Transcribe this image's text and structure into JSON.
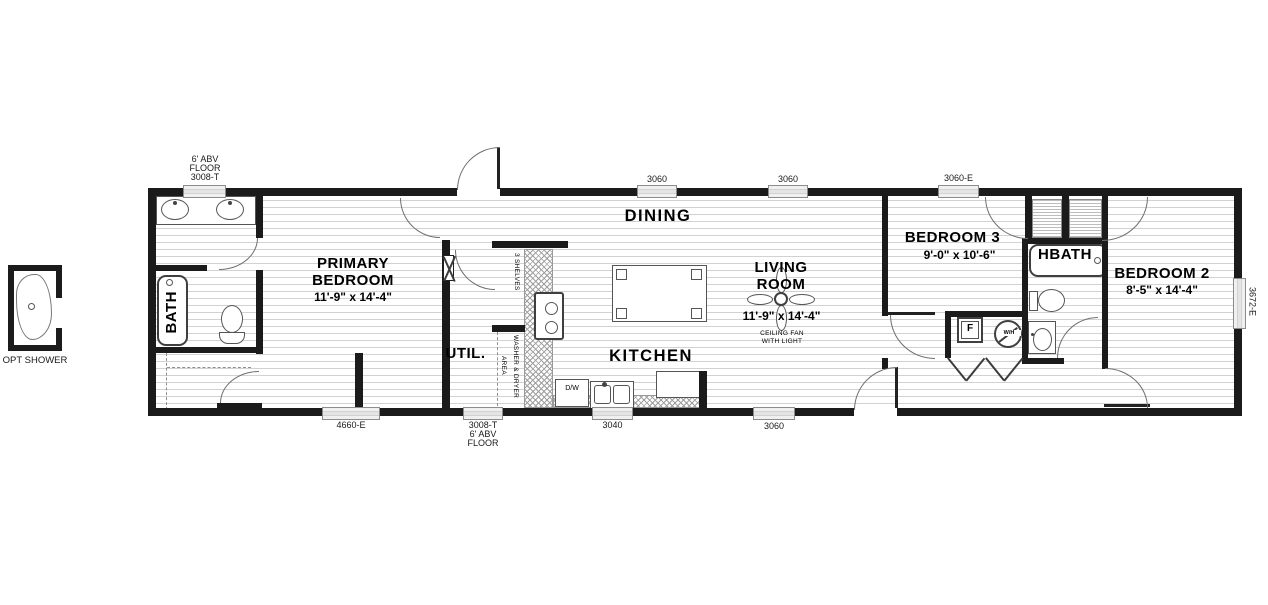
{
  "plan": {
    "opt_shower": {
      "label": "OPT SHOWER"
    },
    "rooms": {
      "bath": {
        "name": "BATH"
      },
      "primary_bedroom": {
        "l1": "PRIMARY",
        "l2": "BEDROOM",
        "dims": "11'-9\" x  14'-4\""
      },
      "util": {
        "name": "UTIL."
      },
      "shelves": {
        "name": "3 SHELVES"
      },
      "washer_dryer": {
        "l1": "WASHER & DRYER",
        "l2": "AREA"
      },
      "kitchen": {
        "name": "KITCHEN",
        "dishwasher": "D/W"
      },
      "dining": {
        "name": "DINING"
      },
      "living_room": {
        "l1": "LIVING",
        "l2": "ROOM",
        "dims": "11'-9\" x  14'-4\"",
        "fan1": "CEILING FAN",
        "fan2": "WITH LIGHT"
      },
      "bedroom3": {
        "name": "BEDROOM 3",
        "dims": "9'-0\" x  10'-6\""
      },
      "hbath": {
        "name": "HBATH"
      },
      "bedroom2": {
        "name": "BEDROOM 2",
        "dims": "8'-5\" x  14'-4\""
      },
      "mech": {
        "furnace": "F",
        "water_heater": "W/H"
      }
    },
    "windows": {
      "top_primary": {
        "l1": "6' ABV",
        "l2": "FLOOR",
        "l3": "3008-T"
      },
      "top_dining_a": {
        "label": "3060"
      },
      "top_dining_b": {
        "label": "3060"
      },
      "top_bedroom3": {
        "label": "3060-E"
      },
      "bottom_primary": {
        "label": "4660-E"
      },
      "bottom_util": {
        "l1": "3008-T",
        "l2": "6' ABV",
        "l3": "FLOOR"
      },
      "bottom_kitchen": {
        "label": "3040"
      },
      "bottom_living": {
        "label": "3060"
      },
      "right_bedroom2": {
        "label": "3672-E"
      }
    }
  }
}
